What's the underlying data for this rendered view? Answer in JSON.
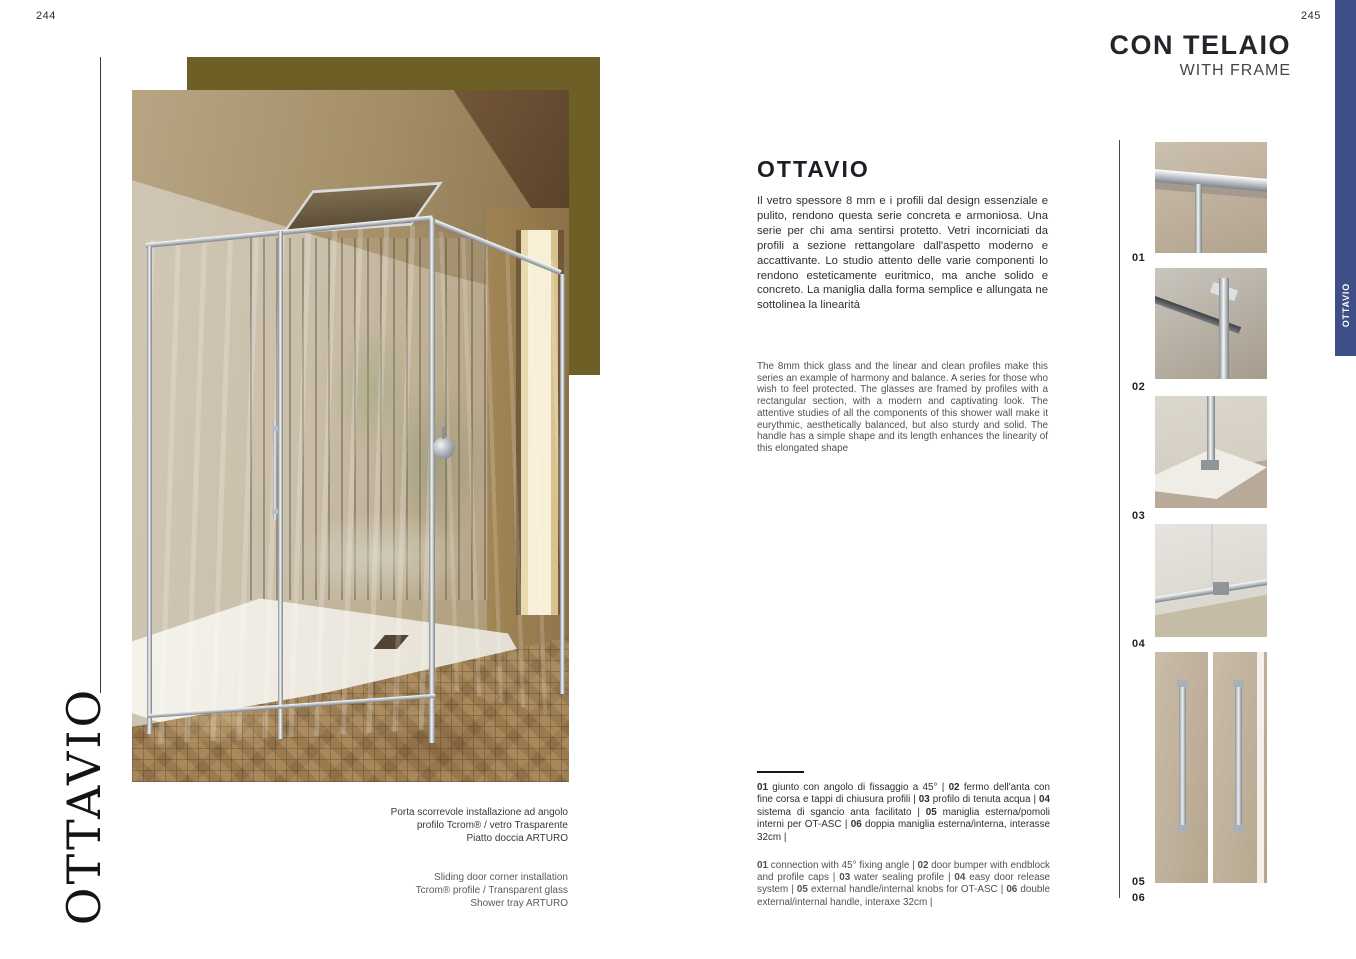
{
  "page": {
    "left_number": "244",
    "right_number": "245"
  },
  "left_page": {
    "series_vertical_title": "OTTAVIO",
    "caption_it": {
      "line1": "Porta scorrevole installazione ad angolo",
      "line2": "profilo Tcrom® / vetro Trasparente",
      "line3": "Piatto doccia ARTURO"
    },
    "caption_en": {
      "line1": "Sliding door corner installation",
      "line2": "Tcrom® profile / Transparent glass",
      "line3": "Shower tray ARTURO"
    }
  },
  "right_page": {
    "header_title": "CON TELAIO",
    "header_subtitle": "WITH FRAME",
    "product_title": "OTTAVIO",
    "description_it": "Il vetro spessore 8 mm e i profili dal design essenziale e pulito, rendono questa serie concreta e armoniosa. Una serie per chi ama sentirsi protetto. Vetri incorniciati da profili a sezione rettangolare dall'aspetto moderno e accattivante. Lo studio attento delle varie componenti lo rendono esteticamente euritmico, ma anche solido e concreto. La maniglia dalla forma semplice e allungata ne sottolinea la linearità",
    "description_en": "The 8mm thick glass and the linear and clean profiles make this series an example of harmony and balance. A series for those who wish to feel protected. The glasses are framed by profiles with a rectangular section, with a modern and captivating look. The attentive studies of all the components of this shower wall make it eurythmic, aesthetically balanced, but also sturdy and solid. The handle has a simple shape and its length enhances the linearity of this elongated shape",
    "legend_it": [
      {
        "num": "01",
        "text": "giunto con angolo di fissaggio a 45°"
      },
      {
        "num": "02",
        "text": "fermo dell'anta con fine corsa e tappi di chiusura profili"
      },
      {
        "num": "03",
        "text": "profilo di tenuta acqua"
      },
      {
        "num": "04",
        "text": "sistema di sgancio anta facilitato"
      },
      {
        "num": "05",
        "text": "maniglia esterna/pomoli interni per OT-ASC"
      },
      {
        "num": "06",
        "text": "doppia maniglia esterna/interna, interasse 32cm"
      }
    ],
    "legend_en": [
      {
        "num": "01",
        "text": "connection with 45° fixing angle"
      },
      {
        "num": "02",
        "text": "door bumper with endblock and profile caps"
      },
      {
        "num": "03",
        "text": "water sealing profile"
      },
      {
        "num": "04",
        "text": "easy door release system"
      },
      {
        "num": "05",
        "text": "external handle/internal knobs for OT-ASC"
      },
      {
        "num": "06",
        "text": "double external/internal handle, interaxe 32cm"
      }
    ],
    "detail_labels": [
      "01",
      "02",
      "03",
      "04",
      "05",
      "06"
    ],
    "tab_label": "OTTAVIO"
  },
  "colors": {
    "accent_gold": "#6d5f26",
    "tab_blue": "#3e4e86",
    "text_dark": "#1f2023",
    "text_gray": "#515256"
  }
}
